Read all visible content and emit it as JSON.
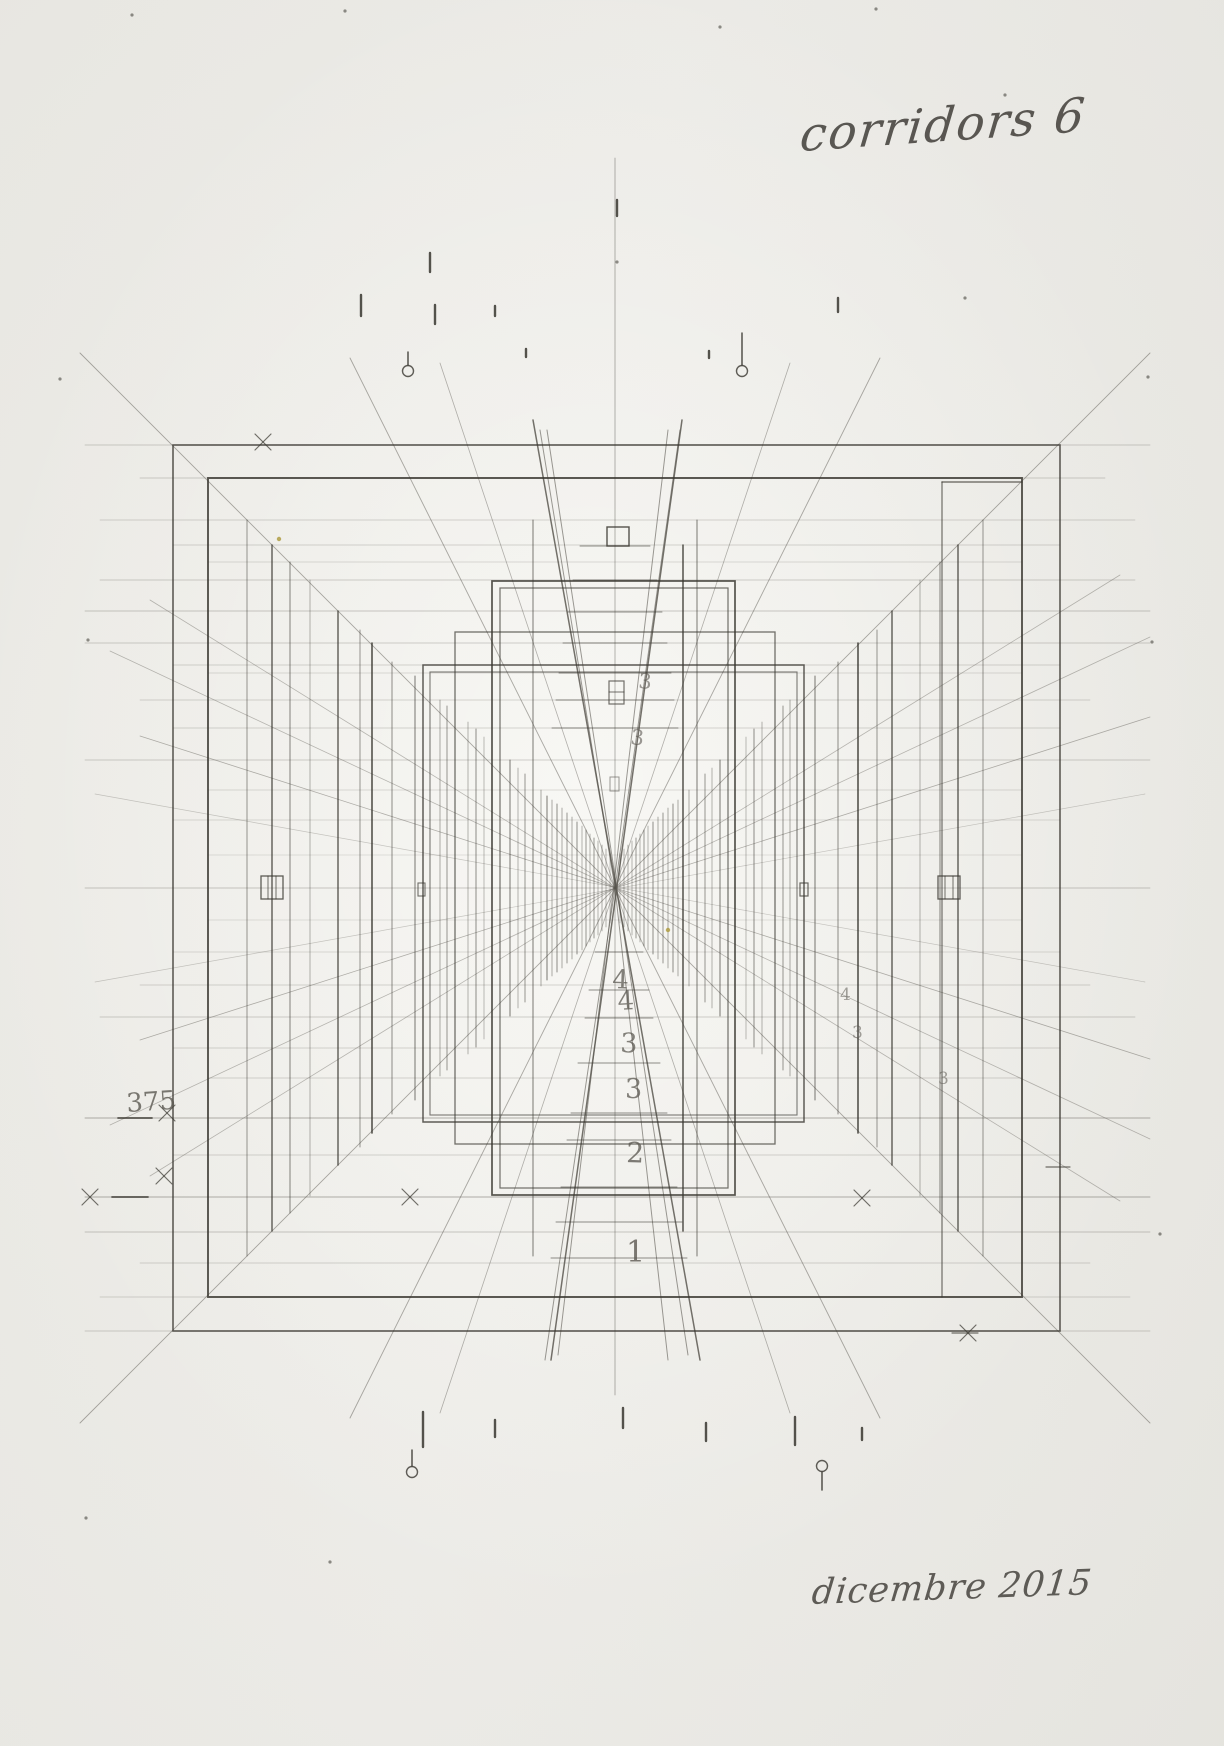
{
  "annotations": {
    "title": "corridors 6",
    "date": "dicembre 2015"
  },
  "colors": {
    "pencil_dark": "#38362f",
    "pencil_mid": "#5c5952",
    "pencil_faint": "#8e8b83",
    "speck": "#ad9a3a",
    "paper": "#f0efeb"
  },
  "drawing": {
    "vp": [
      615,
      888
    ],
    "frames": [
      [
        173,
        445,
        887,
        886,
        1.6,
        0.8
      ],
      [
        208,
        478,
        814,
        819,
        1.9,
        0.85
      ],
      [
        423,
        665,
        381,
        457,
        1.5,
        0.8
      ],
      [
        430,
        672,
        367,
        443,
        1.1,
        0.65
      ],
      [
        492,
        581,
        243,
        614,
        1.7,
        0.85
      ],
      [
        500,
        588,
        228,
        600,
        1.2,
        0.7
      ],
      [
        455,
        632,
        320,
        512,
        1.3,
        0.7
      ],
      [
        261,
        876,
        22,
        23,
        1.3,
        0.8
      ],
      [
        938,
        876,
        22,
        23,
        1.3,
        0.8
      ],
      [
        418,
        883,
        7,
        13,
        1.1,
        0.7
      ],
      [
        800,
        883,
        8,
        13,
        1.2,
        0.75
      ],
      [
        607,
        527,
        22,
        19,
        1.4,
        0.85
      ],
      [
        609,
        681,
        15,
        23,
        1.2,
        0.7
      ],
      [
        610,
        777,
        9,
        14,
        1.0,
        0.5
      ]
    ],
    "verticals": [
      [
        247,
        520,
        1256,
        1.0,
        0.5
      ],
      [
        983,
        520,
        1256,
        1.0,
        0.5
      ],
      [
        272,
        545,
        1231,
        1.4,
        0.8
      ],
      [
        958,
        545,
        1231,
        1.4,
        0.8
      ],
      [
        290,
        562,
        1213,
        1.0,
        0.6
      ],
      [
        940,
        562,
        1213,
        1.0,
        0.6
      ],
      [
        310,
        580,
        1196,
        0.8,
        0.45
      ],
      [
        920,
        580,
        1196,
        0.8,
        0.45
      ],
      [
        338,
        611,
        1165,
        1.5,
        0.75
      ],
      [
        892,
        611,
        1165,
        1.5,
        0.75
      ],
      [
        360,
        630,
        1147,
        1.0,
        0.5
      ],
      [
        877,
        630,
        1147,
        1.0,
        0.5
      ],
      [
        372,
        643,
        1133,
        1.6,
        0.85
      ],
      [
        858,
        643,
        1133,
        1.6,
        0.85
      ],
      [
        392,
        662,
        1114,
        1.0,
        0.55
      ],
      [
        838,
        662,
        1114,
        1.0,
        0.55
      ],
      [
        415,
        676,
        1100,
        1.1,
        0.6
      ],
      [
        815,
        676,
        1100,
        1.1,
        0.6
      ],
      [
        440,
        700,
        1076,
        0.8,
        0.5
      ],
      [
        790,
        700,
        1076,
        0.8,
        0.5
      ],
      [
        447,
        706,
        1070,
        1.0,
        0.5
      ],
      [
        783,
        706,
        1070,
        1.0,
        0.5
      ],
      [
        468,
        722,
        1054,
        0.8,
        0.45
      ],
      [
        762,
        722,
        1054,
        0.8,
        0.45
      ],
      [
        476,
        729,
        1047,
        1.0,
        0.55
      ],
      [
        754,
        729,
        1047,
        1.0,
        0.55
      ],
      [
        484,
        737,
        1039,
        0.8,
        0.4
      ],
      [
        746,
        737,
        1039,
        0.8,
        0.4
      ],
      [
        510,
        760,
        1016,
        1.1,
        0.6
      ],
      [
        720,
        760,
        1016,
        1.1,
        0.6
      ],
      [
        518,
        768,
        1008,
        0.8,
        0.45
      ],
      [
        712,
        768,
        1008,
        0.8,
        0.45
      ],
      [
        525,
        774,
        1002,
        1.0,
        0.5
      ],
      [
        705,
        774,
        1002,
        1.0,
        0.5
      ],
      [
        533,
        520,
        1256,
        1.0,
        0.65
      ],
      [
        697,
        520,
        1256,
        1.0,
        0.65
      ],
      [
        683,
        545,
        1231,
        1.6,
        0.8
      ],
      [
        547,
        796,
        980,
        1.1,
        0.6
      ],
      [
        541,
        790,
        986,
        0.8,
        0.5
      ],
      [
        689,
        790,
        986,
        0.8,
        0.5
      ],
      [
        552,
        800,
        976,
        0.8,
        0.5
      ],
      [
        678,
        800,
        976,
        0.8,
        0.5
      ],
      [
        557,
        804,
        972,
        1.0,
        0.55
      ],
      [
        673,
        804,
        972,
        1.0,
        0.55
      ],
      [
        562,
        808,
        968,
        0.8,
        0.5
      ],
      [
        668,
        808,
        968,
        0.8,
        0.5
      ],
      [
        567,
        813,
        963,
        1.0,
        0.5
      ],
      [
        663,
        813,
        963,
        1.0,
        0.5
      ],
      [
        572,
        817,
        959,
        0.8,
        0.5
      ],
      [
        658,
        817,
        959,
        0.8,
        0.5
      ],
      [
        577,
        822,
        954,
        1.0,
        0.55
      ],
      [
        653,
        822,
        954,
        1.0,
        0.55
      ],
      [
        582,
        826,
        950,
        0.8,
        0.45
      ],
      [
        648,
        826,
        950,
        0.8,
        0.45
      ],
      [
        586,
        830,
        946,
        1.0,
        0.5
      ],
      [
        644,
        830,
        946,
        1.0,
        0.5
      ],
      [
        590,
        834,
        942,
        0.8,
        0.45
      ],
      [
        640,
        834,
        942,
        0.8,
        0.45
      ],
      [
        594,
        838,
        938,
        1.0,
        0.5
      ],
      [
        636,
        838,
        938,
        1.0,
        0.5
      ],
      [
        598,
        841,
        935,
        0.8,
        0.45
      ],
      [
        632,
        841,
        935,
        0.8,
        0.45
      ],
      [
        602,
        845,
        931,
        0.8,
        0.5
      ],
      [
        628,
        845,
        931,
        0.8,
        0.5
      ],
      [
        606,
        849,
        927,
        0.8,
        0.45
      ],
      [
        624,
        849,
        927,
        0.8,
        0.45
      ],
      [
        610,
        853,
        923,
        0.7,
        0.4
      ],
      [
        620,
        853,
        923,
        0.7,
        0.4
      ],
      [
        942,
        482,
        1297,
        1.2,
        0.7
      ],
      [
        615,
        158,
        1395,
        0.8,
        0.45
      ]
    ],
    "horizontals": [
      [
        445,
        85,
        1150,
        0.8,
        0.35
      ],
      [
        478,
        140,
        1105,
        0.8,
        0.35
      ],
      [
        520,
        100,
        1135,
        0.7,
        0.3
      ],
      [
        545,
        173,
        1060,
        0.7,
        0.3
      ],
      [
        562,
        208,
        1022,
        0.7,
        0.25
      ],
      [
        580,
        100,
        1135,
        0.8,
        0.35
      ],
      [
        611,
        85,
        1150,
        0.8,
        0.4
      ],
      [
        643,
        85,
        1150,
        0.8,
        0.35
      ],
      [
        665,
        173,
        1060,
        0.7,
        0.3
      ],
      [
        673,
        208,
        1022,
        0.7,
        0.25
      ],
      [
        700,
        140,
        1090,
        0.7,
        0.3
      ],
      [
        728,
        173,
        1060,
        0.7,
        0.3
      ],
      [
        760,
        85,
        1150,
        0.8,
        0.35
      ],
      [
        790,
        208,
        1022,
        0.7,
        0.25
      ],
      [
        820,
        173,
        1060,
        0.7,
        0.25
      ],
      [
        855,
        208,
        1022,
        0.7,
        0.2
      ],
      [
        888,
        85,
        1150,
        0.8,
        0.4
      ],
      [
        920,
        208,
        1022,
        0.7,
        0.2
      ],
      [
        952,
        173,
        1060,
        0.7,
        0.25
      ],
      [
        985,
        140,
        1090,
        0.7,
        0.3
      ],
      [
        1017,
        100,
        1135,
        0.8,
        0.35
      ],
      [
        1048,
        173,
        1060,
        0.7,
        0.3
      ],
      [
        1078,
        208,
        1022,
        0.7,
        0.3
      ],
      [
        1118,
        85,
        1150,
        0.9,
        0.45
      ],
      [
        1155,
        173,
        1060,
        0.7,
        0.3
      ],
      [
        1197,
        85,
        1150,
        0.9,
        0.45
      ],
      [
        1232,
        85,
        1150,
        0.8,
        0.4
      ],
      [
        1263,
        140,
        1090,
        0.7,
        0.3
      ],
      [
        1297,
        100,
        1130,
        0.7,
        0.3
      ],
      [
        1331,
        85,
        1150,
        0.8,
        0.35
      ],
      [
        482,
        942,
        1022,
        1.5,
        0.8
      ]
    ],
    "centerlines": [
      [
        546,
        580,
        650
      ],
      [
        580,
        573,
        657
      ],
      [
        612,
        568,
        662
      ],
      [
        643,
        563,
        667
      ],
      [
        673,
        559,
        671
      ],
      [
        700,
        556,
        674
      ],
      [
        728,
        552,
        678
      ],
      [
        952,
        595,
        643
      ],
      [
        990,
        589,
        649
      ],
      [
        1018,
        585,
        653
      ],
      [
        1063,
        578,
        660
      ],
      [
        1113,
        571,
        667
      ],
      [
        1140,
        567,
        671
      ],
      [
        1187,
        561,
        677
      ],
      [
        1222,
        556,
        682
      ],
      [
        1258,
        551,
        687
      ]
    ],
    "rays": [
      [
        80,
        353,
        1150,
        1423,
        0.9,
        0.5
      ],
      [
        1150,
        353,
        80,
        1423,
        0.9,
        0.5
      ],
      [
        140,
        736,
        1150,
        1059,
        0.8,
        0.45
      ],
      [
        140,
        1040,
        1150,
        717,
        0.8,
        0.45
      ],
      [
        110,
        651,
        1150,
        1139,
        0.8,
        0.4
      ],
      [
        110,
        1125,
        1150,
        637,
        0.8,
        0.4
      ],
      [
        150,
        600,
        1120,
        1201,
        0.8,
        0.4
      ],
      [
        150,
        1176,
        1120,
        575,
        0.8,
        0.4
      ],
      [
        350,
        358,
        880,
        1418,
        0.9,
        0.5
      ],
      [
        880,
        358,
        350,
        1418,
        0.9,
        0.5
      ],
      [
        440,
        363,
        790,
        1413,
        0.8,
        0.45
      ],
      [
        790,
        363,
        440,
        1413,
        0.8,
        0.45
      ],
      [
        95,
        794,
        1145,
        982,
        0.7,
        0.3
      ],
      [
        95,
        982,
        1145,
        794,
        0.7,
        0.3
      ],
      [
        533,
        420,
        700,
        1360,
        1.5,
        0.85
      ],
      [
        682,
        420,
        551,
        1360,
        1.5,
        0.85
      ],
      [
        547,
        430,
        688,
        1355,
        1.0,
        0.6
      ],
      [
        668,
        430,
        558,
        1355,
        1.0,
        0.6
      ],
      [
        615,
        888,
        545,
        1360,
        1.0,
        0.6
      ],
      [
        615,
        888,
        668,
        1360,
        1.0,
        0.6
      ],
      [
        615,
        888,
        540,
        430,
        1.0,
        0.6
      ],
      [
        615,
        888,
        680,
        430,
        1.0,
        0.6
      ]
    ],
    "extralines": [
      [
        268,
        876,
        268,
        899,
        1.0,
        0.7
      ],
      [
        276,
        876,
        276,
        899,
        1.0,
        0.7
      ],
      [
        945,
        876,
        945,
        899,
        1.0,
        0.7
      ],
      [
        953,
        876,
        953,
        899,
        1.0,
        0.7
      ],
      [
        609,
        692,
        624,
        692,
        1.1,
        0.7
      ],
      [
        1046,
        1167,
        1070,
        1167,
        1.2,
        0.7
      ],
      [
        952,
        1333,
        978,
        1333,
        1.2,
        0.7
      ],
      [
        118,
        1118,
        152,
        1118,
        1.8,
        0.8
      ],
      [
        112,
        1197,
        148,
        1197,
        1.8,
        0.8
      ]
    ],
    "ticks": [
      [
        430,
        253,
        272
      ],
      [
        361,
        295,
        316
      ],
      [
        435,
        305,
        324
      ],
      [
        495,
        306,
        316
      ],
      [
        526,
        349,
        357
      ],
      [
        617,
        200,
        216
      ],
      [
        709,
        351,
        358
      ],
      [
        838,
        298,
        312
      ],
      [
        423,
        1412,
        1447
      ],
      [
        495,
        1420,
        1437
      ],
      [
        623,
        1408,
        1428
      ],
      [
        706,
        1423,
        1441
      ],
      [
        795,
        1417,
        1445
      ],
      [
        862,
        1428,
        1440
      ]
    ],
    "crosses": [
      [
        167,
        1113
      ],
      [
        164,
        1176
      ],
      [
        263,
        442
      ],
      [
        90,
        1197
      ],
      [
        862,
        1198
      ],
      [
        968,
        1333
      ],
      [
        410,
        1197
      ]
    ],
    "lollipops": [
      [
        408,
        371,
        352
      ],
      [
        742,
        371,
        333
      ],
      [
        412,
        1472,
        1450
      ],
      [
        822,
        1466,
        1490
      ]
    ],
    "dots": [
      [
        132,
        15
      ],
      [
        345,
        11
      ],
      [
        876,
        9
      ],
      [
        720,
        27
      ],
      [
        60,
        379
      ],
      [
        1148,
        377
      ],
      [
        617,
        262
      ],
      [
        1160,
        1234
      ],
      [
        88,
        640
      ],
      [
        1152,
        642
      ],
      [
        330,
        1562
      ],
      [
        86,
        1518
      ],
      [
        965,
        298
      ],
      [
        1005,
        95
      ]
    ],
    "specks": [
      [
        279,
        539
      ],
      [
        668,
        930
      ]
    ],
    "labels": [
      [
        "375",
        127,
        1112,
        26,
        -4,
        0.8
      ],
      [
        "4",
        612,
        988,
        26,
        2,
        0.75
      ],
      [
        "4",
        618,
        1010,
        26,
        -3,
        0.75
      ],
      [
        "3",
        620,
        1052,
        27,
        2,
        0.75
      ],
      [
        "3",
        625,
        1098,
        27,
        0,
        0.75
      ],
      [
        "2",
        626,
        1162,
        28,
        2,
        0.78
      ],
      [
        "1",
        626,
        1262,
        30,
        0,
        0.8
      ],
      [
        "3",
        638,
        688,
        21,
        4,
        0.6
      ],
      [
        "3",
        630,
        744,
        21,
        6,
        0.6
      ],
      [
        "4",
        840,
        1000,
        17,
        0,
        0.55
      ],
      [
        "3",
        852,
        1038,
        17,
        0,
        0.55
      ],
      [
        "3",
        938,
        1084,
        17,
        0,
        0.55
      ]
    ]
  }
}
